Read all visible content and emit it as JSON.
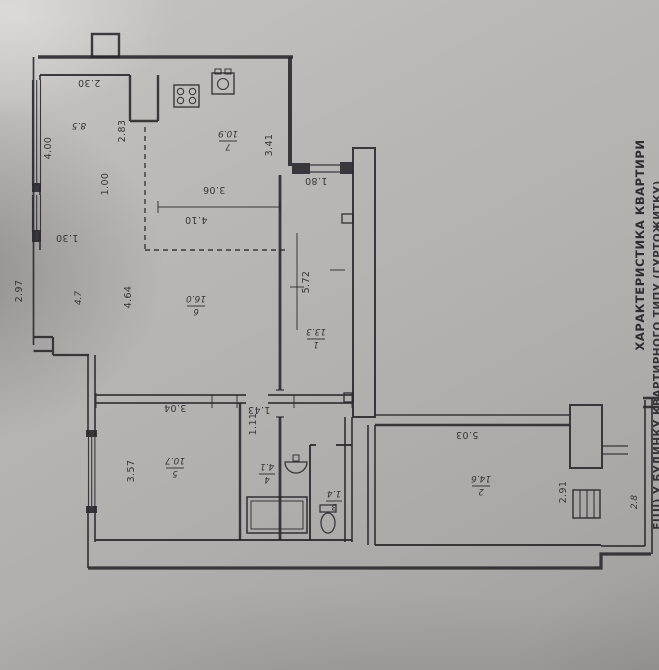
{
  "photo": {
    "caption_line1": "ХАРАКТЕРИСТИКА КВАРТИРИ",
    "caption_line2": "ЕЦІЇ) У БУДИНКУ КВАРТИРНОГО ТИПУ (ГУРТОЖИТКУ)",
    "ink_color": "#2a292d",
    "paper_color": "#b2b0ae"
  },
  "rooms": [
    {
      "number": "",
      "area": "8.5"
    },
    {
      "number": "7",
      "area": "10.9"
    },
    {
      "number": "6",
      "area": "16.0"
    },
    {
      "number": "1",
      "area": "13.3"
    },
    {
      "number": "5",
      "area": "10.7"
    },
    {
      "number": "4",
      "area": "4.1"
    },
    {
      "number": "3",
      "area": "1.4"
    },
    {
      "number": "2",
      "area": "14.6"
    },
    {
      "number": "",
      "area": "4.7"
    },
    {
      "number": "",
      "area": "2.8"
    }
  ],
  "dimensions": [
    {
      "t": "2.30"
    },
    {
      "t": "4.00"
    },
    {
      "t": "2.83"
    },
    {
      "t": "1.00"
    },
    {
      "t": "1.30"
    },
    {
      "t": "2.97"
    },
    {
      "t": "4.64"
    },
    {
      "t": "3.06"
    },
    {
      "t": "4.10"
    },
    {
      "t": "3.41"
    },
    {
      "t": "1.80"
    },
    {
      "t": "5.72"
    },
    {
      "t": "3.04"
    },
    {
      "t": "1.43"
    },
    {
      "t": "1.11"
    },
    {
      "t": "3.57"
    },
    {
      "t": "5.03"
    },
    {
      "t": "2.91"
    }
  ]
}
